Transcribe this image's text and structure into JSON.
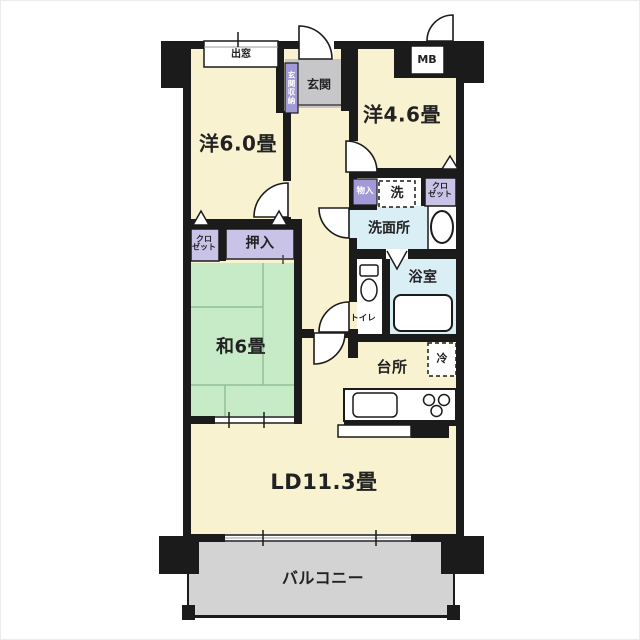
{
  "labels": {
    "bay_window": "出窓",
    "entrance": "玄関",
    "entrance_storage": "玄関収納",
    "meter_box": "MB",
    "western_room_46": "洋4.6畳",
    "western_room_60": "洋6.0畳",
    "storage": "物入",
    "washer": "洗",
    "closet_right": "クロ\nゼット",
    "closet_left": "クロ\nゼット",
    "washroom": "洗面所",
    "oshiire": "押入",
    "bathroom": "浴室",
    "toilet": "トイレ",
    "japanese_room": "和6畳",
    "refrigerator": "冷",
    "kitchen": "台所",
    "living_dining": "LD11.3畳",
    "balcony": "バルコニー"
  },
  "colors": {
    "room": "#f8f2d0",
    "tatami": "#c6ebc6",
    "closet": "#c9c4e7",
    "storage_dark": "#a29ad6",
    "water": "#d9eef5",
    "entrance_gray": "#c7c7c9",
    "balcony_gray": "#d3d3d3",
    "wall": "#1b1b1b",
    "tatami_line": "#90c194"
  }
}
